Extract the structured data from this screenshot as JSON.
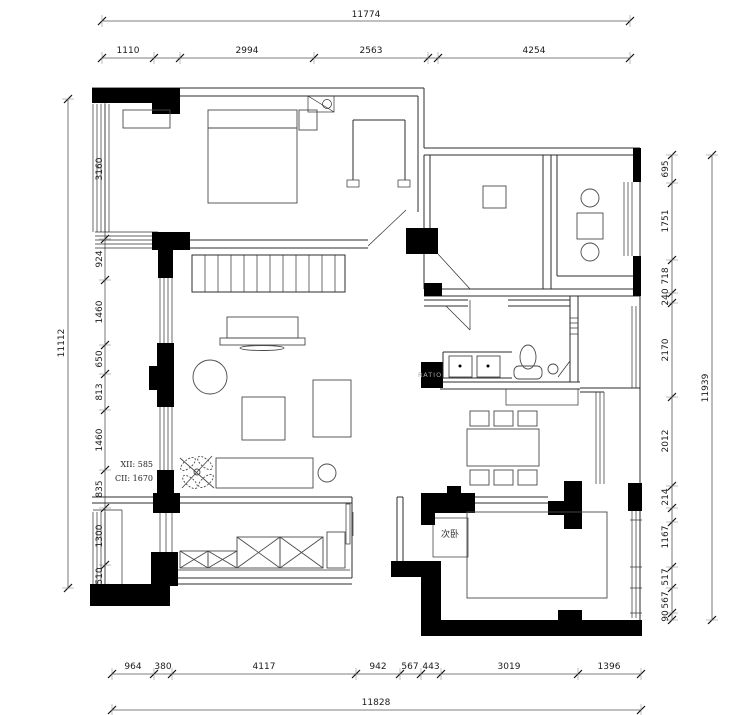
{
  "drawing": {
    "room_label": "次卧",
    "annotation_line1": "XII: 585",
    "annotation_line2": "CII: 1670",
    "watermark": "RATIO",
    "colors": {
      "wall_fill": "#000000",
      "line": "#2e2e2e",
      "dim_text": "#1a1a1a",
      "watermark": "#a8a8a8"
    }
  },
  "dims": {
    "top": {
      "total": "11774",
      "segments": [
        "1110",
        "2994",
        "2563",
        "4254"
      ]
    },
    "left": {
      "total": "11112",
      "segments": [
        "3160",
        "924",
        "1460",
        "650",
        "813",
        "1460",
        "835",
        "1300",
        "510"
      ]
    },
    "right": {
      "total": "11939",
      "segments": [
        "695",
        "1751",
        "718",
        "240",
        "2170",
        "2012",
        "214",
        "1167",
        "517",
        "567",
        "90"
      ]
    },
    "bottom": {
      "total": "11828",
      "segments": [
        "964",
        "380",
        "4117",
        "942",
        "567",
        "443",
        "3019",
        "1396"
      ]
    }
  }
}
